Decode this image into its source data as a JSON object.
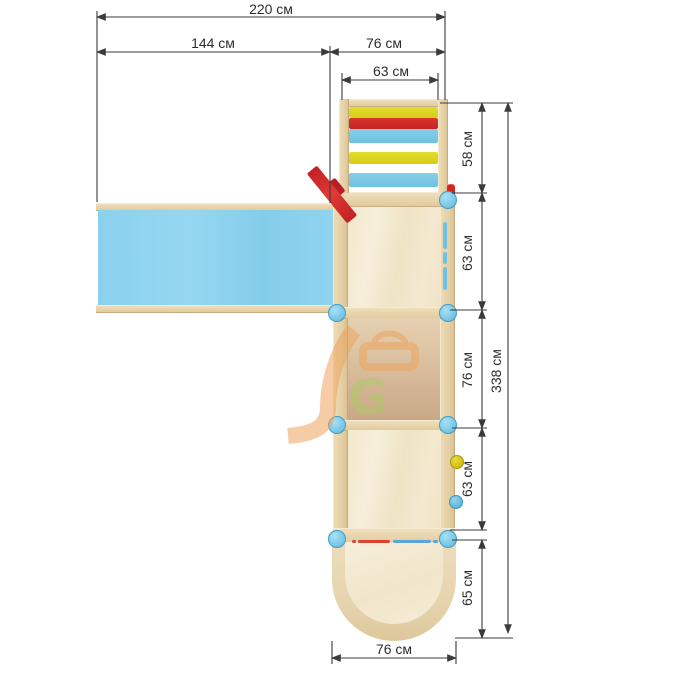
{
  "drawing": {
    "title": "playground-tower-top-view",
    "labels": {
      "total_width": "220 см",
      "slide_length": "144 см",
      "tower_width": "76 см",
      "ladder_clear_width": "63 см",
      "ladder_section_depth": "58 см",
      "upper_platform_depth": "63 см",
      "middle_platform_depth": "76 см",
      "total_depth": "338 см",
      "lower_platform_depth": "63 см",
      "base_section_depth": "65 см",
      "base_width": "76 см"
    },
    "watermark_letter": "G",
    "ladder_rungs": [
      "yellow",
      "red",
      "blue",
      "yellow",
      "blue"
    ],
    "base_edge_marks": [
      "red",
      "blue"
    ],
    "colors": {
      "slide_panel": "#8ed3ee",
      "rung_yellow": "#dcd41f",
      "rung_red": "#cf2b28",
      "rung_blue": "#79c9e6",
      "wood_light": "#f2e7cb",
      "wood_border": "#e9d6ae",
      "wood_dark": "#d2b595",
      "post_blue": "#7cc8e8",
      "hold_yellow": "#d6c513",
      "hold_blue": "#5fb8dc",
      "flag_red": "#d42a28",
      "watermark_orange": "#eda45e",
      "watermark_green": "#aecb67",
      "dimension_line": "#3b3b3b"
    }
  }
}
